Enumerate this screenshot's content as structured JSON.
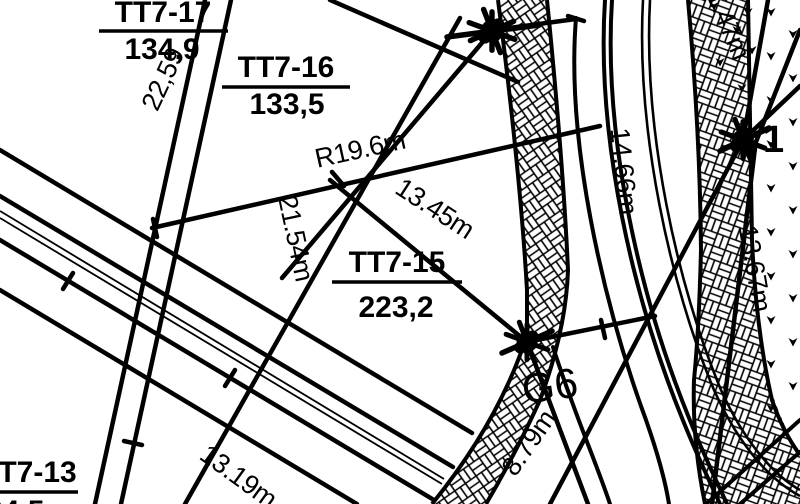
{
  "title": "Cadastral plot plan fragment",
  "parcels": {
    "tt7_17": {
      "name": "TT7-17",
      "area": "134,9"
    },
    "tt7_16": {
      "name": "TT7-16",
      "area": "133,5"
    },
    "tt7_15": {
      "name": "TT7-15",
      "area": "223,2"
    },
    "tt7_13": {
      "name": "TT7-13",
      "area": "24,5"
    }
  },
  "points": {
    "g6": {
      "label": "G6"
    },
    "pt1": {
      "label": "1"
    }
  },
  "measurements": {
    "d22_59": "22,59",
    "r19_6": "R19.6m",
    "d13_45": "13.45m",
    "d21_54": "21.54m",
    "d14_66": "14.66m",
    "d1_47": "1.47m",
    "d13_67": "13.67m",
    "d8_79": "8.79m",
    "d13_19": "13.19m"
  },
  "symbols": {
    "survey_marker": "star-point-marker",
    "road_hatch": "basket-weave-hatch",
    "vegetation": "grass-tick-marks"
  },
  "colors": {
    "ink": "#000000",
    "paper": "#ffffff"
  }
}
